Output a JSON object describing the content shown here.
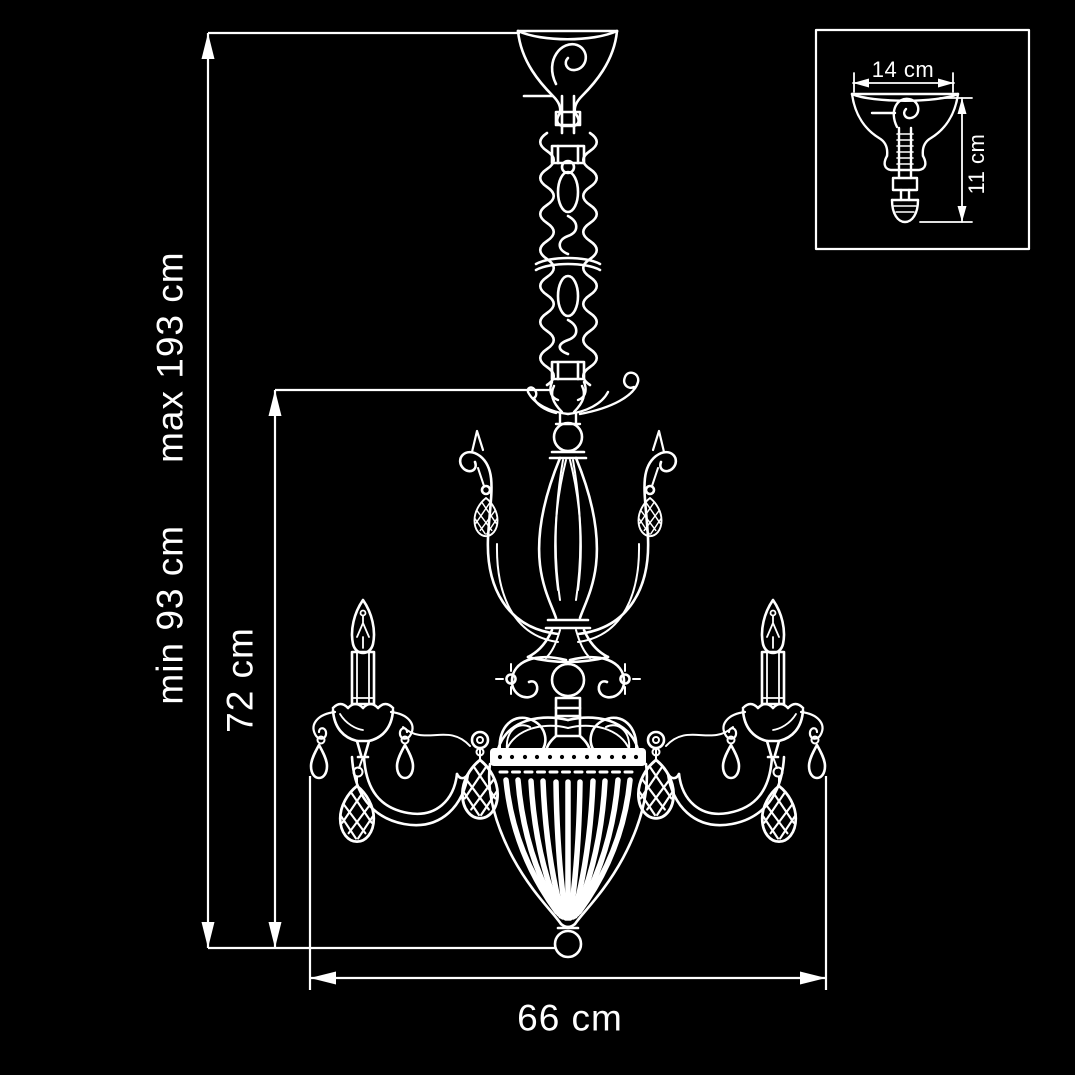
{
  "diagram": {
    "type": "technical-dimension-drawing",
    "subject": "crystal chandelier, 2-light, side view",
    "background": "#000000",
    "line_color": "#ffffff",
    "labels": {
      "overall_height_min": "min 93 cm",
      "overall_height_max": "max 193 cm",
      "body_height": "72 cm",
      "body_width": "66 cm"
    },
    "inset": {
      "subject": "ceiling canopy detail",
      "canopy_width": "14 cm",
      "canopy_height": "11 cm"
    }
  }
}
